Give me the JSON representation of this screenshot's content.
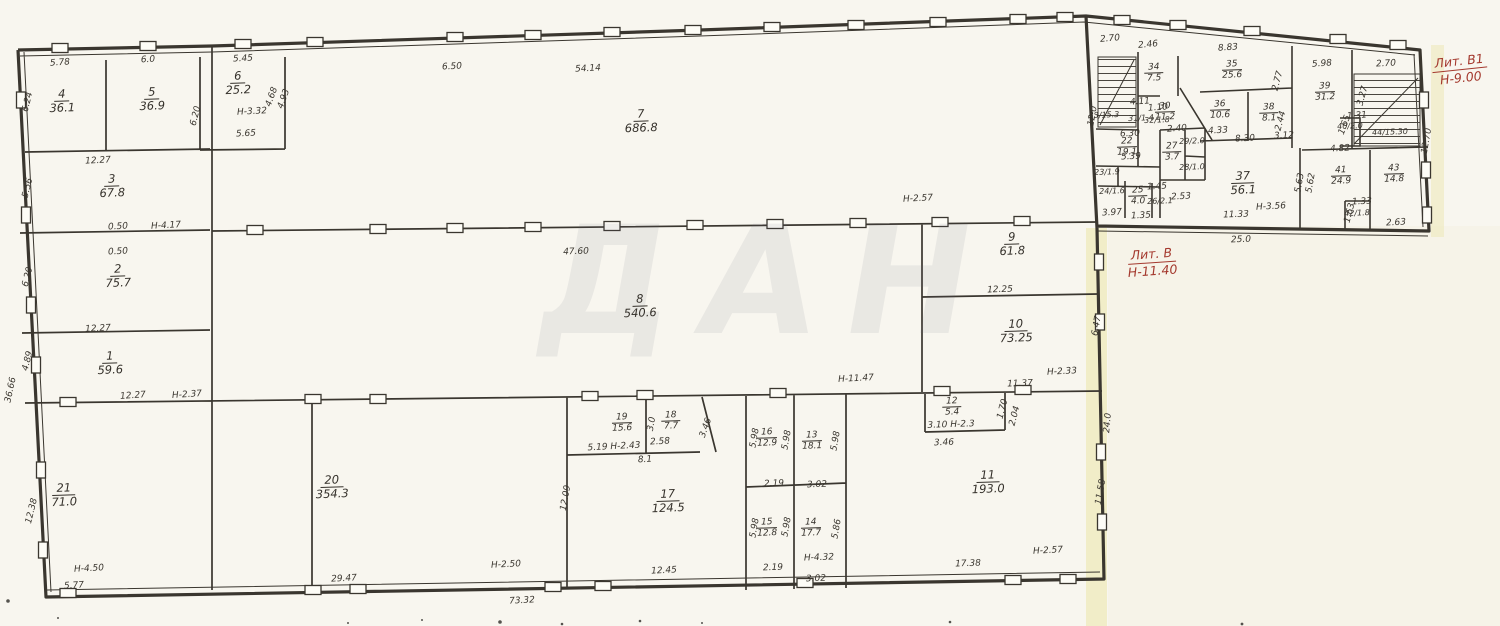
{
  "plan": {
    "watermark": "ДАН",
    "red": [
      {
        "line1": "Лит. В1",
        "line2": "Н-9.00",
        "x": 1460,
        "y": 70,
        "r": -6
      },
      {
        "line1": "Лит. В",
        "line2": "Н-11.40",
        "x": 1152,
        "y": 263,
        "r": -4
      }
    ],
    "rooms": [
      {
        "n": "1",
        "a": "59.6",
        "x": 110,
        "y": 363
      },
      {
        "n": "2",
        "a": "75.7",
        "x": 118,
        "y": 276
      },
      {
        "n": "3",
        "a": "67.8",
        "x": 112,
        "y": 186
      },
      {
        "n": "4",
        "a": "36.1",
        "x": 62,
        "y": 101
      },
      {
        "n": "5",
        "a": "36.9",
        "x": 152,
        "y": 99
      },
      {
        "n": "6",
        "a": "25.2",
        "x": 238,
        "y": 83
      },
      {
        "n": "7",
        "a": "686.8",
        "x": 641,
        "y": 121
      },
      {
        "n": "8",
        "a": "540.6",
        "x": 640,
        "y": 306
      },
      {
        "n": "9",
        "a": "61.8",
        "x": 1012,
        "y": 244
      },
      {
        "n": "10",
        "a": "73.25",
        "x": 1016,
        "y": 331
      },
      {
        "n": "11",
        "a": "193.0",
        "x": 988,
        "y": 482
      },
      {
        "n": "12",
        "a": "5.4",
        "x": 952,
        "y": 407,
        "s": 1
      },
      {
        "n": "13",
        "a": "18.1",
        "x": 812,
        "y": 441,
        "s": 1
      },
      {
        "n": "14",
        "a": "17.7",
        "x": 811,
        "y": 528,
        "s": 1
      },
      {
        "n": "15",
        "a": "12.8",
        "x": 767,
        "y": 528,
        "s": 1
      },
      {
        "n": "16",
        "a": "12.9",
        "x": 767,
        "y": 438,
        "s": 1
      },
      {
        "n": "17",
        "a": "124.5",
        "x": 668,
        "y": 501
      },
      {
        "n": "18",
        "a": "7.7",
        "x": 671,
        "y": 421,
        "s": 1
      },
      {
        "n": "19",
        "a": "15.6",
        "x": 622,
        "y": 423,
        "s": 1
      },
      {
        "n": "20",
        "a": "354.3",
        "x": 332,
        "y": 487
      },
      {
        "n": "21",
        "a": "71.0",
        "x": 64,
        "y": 495
      },
      {
        "n": "22",
        "a": "19.1",
        "x": 1127,
        "y": 147,
        "s": 1
      },
      {
        "n": "23",
        "a": "1.9",
        "x": 1107,
        "y": 173,
        "i": 1
      },
      {
        "n": "24",
        "a": "1.6",
        "x": 1112,
        "y": 192,
        "i": 1
      },
      {
        "n": "25",
        "a": "4.0",
        "x": 1138,
        "y": 196,
        "s": 1
      },
      {
        "n": "26",
        "a": "2.1",
        "x": 1160,
        "y": 202,
        "i": 1
      },
      {
        "n": "27",
        "a": "3.7",
        "x": 1172,
        "y": 152,
        "s": 1
      },
      {
        "n": "28",
        "a": "1.0",
        "x": 1192,
        "y": 168,
        "i": 1
      },
      {
        "n": "29",
        "a": "2.0",
        "x": 1192,
        "y": 142,
        "i": 1
      },
      {
        "n": "30",
        "a": "11.2",
        "x": 1165,
        "y": 112,
        "s": 1
      },
      {
        "n": "31",
        "a": "1.4",
        "x": 1141,
        "y": 119,
        "i": 1
      },
      {
        "n": "32",
        "a": "1.8",
        "x": 1157,
        "y": 121,
        "i": 1
      },
      {
        "n": "33",
        "a": "15.3",
        "x": 1104,
        "y": 116,
        "i": 1
      },
      {
        "n": "34",
        "a": "7.5",
        "x": 1154,
        "y": 73,
        "s": 1
      },
      {
        "n": "35",
        "a": "25.6",
        "x": 1232,
        "y": 70,
        "s": 1
      },
      {
        "n": "36",
        "a": "10.6",
        "x": 1220,
        "y": 110,
        "s": 1
      },
      {
        "n": "37",
        "a": "56.1",
        "x": 1243,
        "y": 183
      },
      {
        "n": "38",
        "a": "8.1",
        "x": 1269,
        "y": 113,
        "s": 1
      },
      {
        "n": "39",
        "a": "31.2",
        "x": 1325,
        "y": 92,
        "s": 1
      },
      {
        "n": "40",
        "a": "2.0",
        "x": 1350,
        "y": 127,
        "i": 1
      },
      {
        "n": "41",
        "a": "24.9",
        "x": 1341,
        "y": 176,
        "s": 1
      },
      {
        "n": "42",
        "a": "1.8",
        "x": 1357,
        "y": 214,
        "i": 1
      },
      {
        "n": "43",
        "a": "14.8",
        "x": 1394,
        "y": 174,
        "s": 1
      },
      {
        "n": "44",
        "a": "15.30",
        "x": 1390,
        "y": 133,
        "i": 1
      }
    ],
    "dims": [
      {
        "t": "5.78",
        "x": 60,
        "y": 63,
        "r": -4
      },
      {
        "t": "6.0",
        "x": 148,
        "y": 60,
        "r": -3
      },
      {
        "t": "5.45",
        "x": 243,
        "y": 59,
        "r": -3
      },
      {
        "t": "Н-3.32",
        "x": 252,
        "y": 112,
        "r": -3
      },
      {
        "t": "5.65",
        "x": 246,
        "y": 134,
        "r": -3
      },
      {
        "t": "6.20",
        "x": 196,
        "y": 116,
        "r": -76
      },
      {
        "t": "4.68",
        "x": 272,
        "y": 97,
        "r": -70
      },
      {
        "t": "4.93",
        "x": 284,
        "y": 99,
        "r": -70
      },
      {
        "t": "6.24",
        "x": 28,
        "y": 102,
        "r": -76
      },
      {
        "t": "12.27",
        "x": 98,
        "y": 161,
        "r": -3
      },
      {
        "t": "5.56",
        "x": 28,
        "y": 188,
        "r": -76
      },
      {
        "t": "0.50",
        "x": 118,
        "y": 227,
        "r": -3
      },
      {
        "t": "Н-4.17",
        "x": 166,
        "y": 226,
        "r": -3
      },
      {
        "t": "0.50",
        "x": 118,
        "y": 252,
        "r": -3
      },
      {
        "t": "6.20",
        "x": 28,
        "y": 277,
        "r": -76
      },
      {
        "t": "12.27",
        "x": 98,
        "y": 329,
        "r": -3
      },
      {
        "t": "4.89",
        "x": 28,
        "y": 361,
        "r": -76
      },
      {
        "t": "36.66",
        "x": 11,
        "y": 390,
        "r": -78
      },
      {
        "t": "12.27",
        "x": 133,
        "y": 396,
        "r": -4
      },
      {
        "t": "Н-2.37",
        "x": 187,
        "y": 395,
        "r": -4
      },
      {
        "t": "12.38",
        "x": 32,
        "y": 511,
        "r": -76
      },
      {
        "t": "Н-4.50",
        "x": 89,
        "y": 569,
        "r": -3
      },
      {
        "t": "5.77",
        "x": 74,
        "y": 586,
        "r": -3
      },
      {
        "t": "6.50",
        "x": 452,
        "y": 67,
        "r": -3
      },
      {
        "t": "54.14",
        "x": 588,
        "y": 69,
        "r": -3
      },
      {
        "t": "47.60",
        "x": 576,
        "y": 252,
        "r": -2
      },
      {
        "t": "Н-2.57",
        "x": 918,
        "y": 199,
        "r": -3
      },
      {
        "t": "12.25",
        "x": 1000,
        "y": 290,
        "r": -2
      },
      {
        "t": "Н-11.47",
        "x": 856,
        "y": 379,
        "r": -3
      },
      {
        "t": "11.37",
        "x": 1020,
        "y": 384,
        "r": -2
      },
      {
        "t": "Н-2.33",
        "x": 1062,
        "y": 372,
        "r": -3
      },
      {
        "t": "6.47",
        "x": 1097,
        "y": 326,
        "r": -80
      },
      {
        "t": "12.09",
        "x": 566,
        "y": 498,
        "r": -80
      },
      {
        "t": "5.19 Н-2.43",
        "x": 614,
        "y": 447,
        "r": -3
      },
      {
        "t": "2.58",
        "x": 660,
        "y": 442,
        "r": -3
      },
      {
        "t": "8.1",
        "x": 645,
        "y": 460,
        "r": -3
      },
      {
        "t": "3.0",
        "x": 652,
        "y": 424,
        "r": -80
      },
      {
        "t": "3.46",
        "x": 706,
        "y": 428,
        "r": -70
      },
      {
        "t": "5.98",
        "x": 755,
        "y": 438,
        "r": -80
      },
      {
        "t": "5.98",
        "x": 787,
        "y": 440,
        "r": -80
      },
      {
        "t": "5.98",
        "x": 836,
        "y": 441,
        "r": -80
      },
      {
        "t": "5.98",
        "x": 755,
        "y": 528,
        "r": -80
      },
      {
        "t": "5.98",
        "x": 787,
        "y": 527,
        "r": -80
      },
      {
        "t": "5.86",
        "x": 837,
        "y": 529,
        "r": -80
      },
      {
        "t": "2.19",
        "x": 774,
        "y": 484,
        "r": -2
      },
      {
        "t": "3.02",
        "x": 817,
        "y": 485,
        "r": -2
      },
      {
        "t": "2.19",
        "x": 773,
        "y": 568,
        "r": -2
      },
      {
        "t": "Н-4.32",
        "x": 819,
        "y": 558,
        "r": -2
      },
      {
        "t": "3.02",
        "x": 816,
        "y": 579,
        "r": -2
      },
      {
        "t": "29.47",
        "x": 344,
        "y": 579,
        "r": -3
      },
      {
        "t": "Н-2.50",
        "x": 506,
        "y": 565,
        "r": -3
      },
      {
        "t": "73.32",
        "x": 522,
        "y": 601,
        "r": -3
      },
      {
        "t": "12.45",
        "x": 664,
        "y": 571,
        "r": -3
      },
      {
        "t": "3.10 Н-2.3",
        "x": 951,
        "y": 425,
        "r": -2
      },
      {
        "t": "3.46",
        "x": 944,
        "y": 443,
        "r": -2
      },
      {
        "t": "1.70",
        "x": 1003,
        "y": 409,
        "r": -75
      },
      {
        "t": "2.04",
        "x": 1015,
        "y": 416,
        "r": -75
      },
      {
        "t": "17.38",
        "x": 968,
        "y": 564,
        "r": -2
      },
      {
        "t": "Н-2.57",
        "x": 1048,
        "y": 551,
        "r": -3
      },
      {
        "t": "24.0",
        "x": 1108,
        "y": 423,
        "r": -85
      },
      {
        "t": "11.58",
        "x": 1101,
        "y": 492,
        "r": -80
      },
      {
        "t": "2.70",
        "x": 1110,
        "y": 39,
        "r": -5
      },
      {
        "t": "2.46",
        "x": 1148,
        "y": 45,
        "r": -5
      },
      {
        "t": "8.83",
        "x": 1228,
        "y": 48,
        "r": -4
      },
      {
        "t": "5.98",
        "x": 1322,
        "y": 64,
        "r": -4
      },
      {
        "t": "2.70",
        "x": 1386,
        "y": 64,
        "r": -3
      },
      {
        "t": "12.70",
        "x": 1427,
        "y": 141,
        "r": -80
      },
      {
        "t": "12.0",
        "x": 1093,
        "y": 116,
        "r": -80
      },
      {
        "t": "4.11",
        "x": 1140,
        "y": 102,
        "r": -4
      },
      {
        "t": "1.10",
        "x": 1158,
        "y": 108,
        "r": -4
      },
      {
        "t": "2.40",
        "x": 1177,
        "y": 129,
        "r": -4
      },
      {
        "t": "6.30",
        "x": 1130,
        "y": 134,
        "r": -3
      },
      {
        "t": "5.39",
        "x": 1131,
        "y": 157,
        "r": -3
      },
      {
        "t": "4.33",
        "x": 1218,
        "y": 131,
        "r": -3
      },
      {
        "t": "8.30",
        "x": 1245,
        "y": 139,
        "r": -3
      },
      {
        "t": "3.12",
        "x": 1284,
        "y": 136,
        "r": -3
      },
      {
        "t": "1.45",
        "x": 1157,
        "y": 187,
        "r": -3
      },
      {
        "t": "2.53",
        "x": 1181,
        "y": 197,
        "r": -3
      },
      {
        "t": "3.97",
        "x": 1112,
        "y": 213,
        "r": -3
      },
      {
        "t": "1.35",
        "x": 1141,
        "y": 216,
        "r": -3
      },
      {
        "t": "11.33",
        "x": 1236,
        "y": 215,
        "r": -2
      },
      {
        "t": "25.0",
        "x": 1241,
        "y": 240,
        "r": -2
      },
      {
        "t": "Н-3.56",
        "x": 1271,
        "y": 207,
        "r": -3
      },
      {
        "t": "5.63",
        "x": 1300,
        "y": 183,
        "r": -80
      },
      {
        "t": "5.62",
        "x": 1311,
        "y": 183,
        "r": -80
      },
      {
        "t": "4.82",
        "x": 1340,
        "y": 149,
        "r": -3
      },
      {
        "t": "1.31",
        "x": 1357,
        "y": 116,
        "r": -4
      },
      {
        "t": "1.65",
        "x": 1345,
        "y": 125,
        "r": -70
      },
      {
        "t": "1.33",
        "x": 1362,
        "y": 202,
        "r": -3
      },
      {
        "t": "1.63",
        "x": 1350,
        "y": 213,
        "r": -75
      },
      {
        "t": "2.63",
        "x": 1396,
        "y": 223,
        "r": -3
      },
      {
        "t": "3.27",
        "x": 1363,
        "y": 96,
        "r": -75
      },
      {
        "t": "2.44",
        "x": 1281,
        "y": 121,
        "r": -75
      },
      {
        "t": "2.77",
        "x": 1278,
        "y": 81,
        "r": -75
      }
    ]
  }
}
